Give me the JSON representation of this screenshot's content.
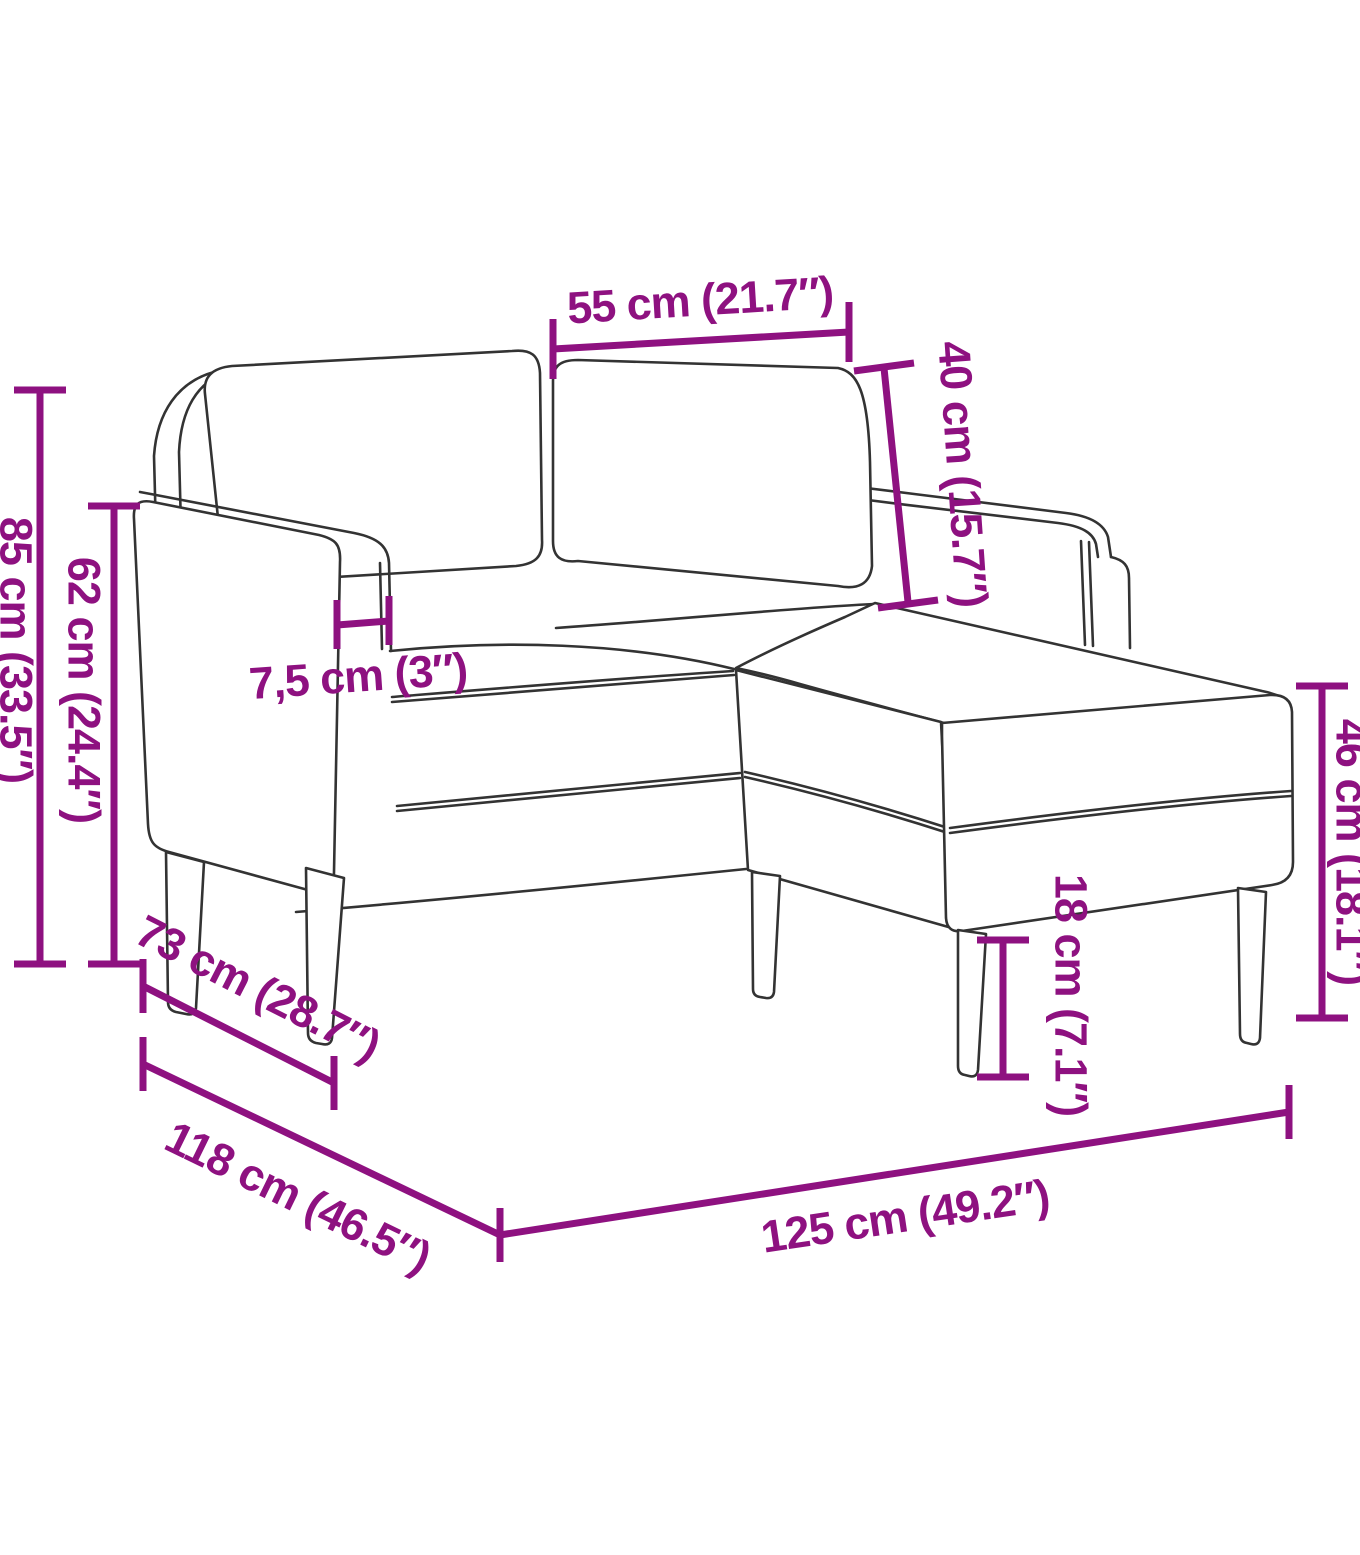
{
  "colors": {
    "dimension_accent": "#8e1180",
    "sofa_outline": "#333333",
    "background": "#ffffff"
  },
  "dimensions": {
    "seat_width": {
      "label": "55 cm (21.7″)"
    },
    "backrest_height": {
      "label": "40 cm (15.7″)"
    },
    "total_height": {
      "label": "85 cm (33.5″)"
    },
    "armrest_height": {
      "label": "62 cm (24.4″)"
    },
    "armrest_width": {
      "label": "7,5 cm (3″)"
    },
    "chaise_height": {
      "label": "46 cm (18.1″)"
    },
    "leg_height": {
      "label": "18 cm (7.1″)"
    },
    "seat_depth": {
      "label": "73 cm (28.7″)"
    },
    "total_depth": {
      "label": "118 cm (46.5″)"
    },
    "total_width": {
      "label": "125 cm (49.2″)"
    }
  }
}
